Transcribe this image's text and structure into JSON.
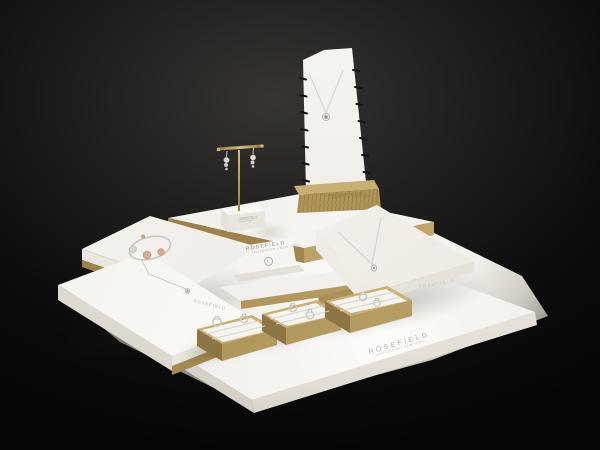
{
  "scene": {
    "description": "Rosefield jewelry counter display set on a dark backdrop",
    "palette": {
      "background": "#0a0a0a",
      "spotlight": "#373431",
      "surface_white": "#f3f1ec",
      "gold": "#a1874f",
      "gold_light": "#c2a96e",
      "wood_gold": "#b2975c",
      "silver": "#cfcdc9",
      "rose_gold": "#d9a890",
      "label_gray": "#aaa49a"
    },
    "brand": {
      "name": "ROSEFIELD",
      "tagline": "AMSTERDAM | NEW YORK"
    },
    "items": {
      "base_platform": {
        "label": "ROSEFIELD",
        "sublabel": "AMSTERDAM | NEW YORK"
      },
      "brand_card": {
        "label": "ROSEFIELD",
        "sublabel": "AMSTERDAM | NEW YORK"
      },
      "earring_stand_cube": {
        "label": "ROSEFIELD",
        "jewelry": "pair of drop earrings"
      },
      "necklace_easel": {
        "label": "ROSEFIELD",
        "sublabel": "AMSTERDAM | NEW YORK",
        "jewelry": "silver pendant necklace"
      },
      "bracelet_wedge": {
        "jewelry": "bangle bracelet with silver and rose-gold beads"
      },
      "necklace_wedge_left": {
        "label": "ROSEFIELD",
        "jewelry": "silver pendant necklace"
      },
      "necklace_wedge_right": {
        "label": "ROSEFIELD",
        "jewelry": "silver pendant necklace"
      },
      "ring_tray_left": {
        "jewelry": "two silver rings"
      },
      "ring_tray_middle": {
        "jewelry": "two silver rings"
      },
      "ring_tray_right": {
        "jewelry": "two silver rings"
      }
    }
  }
}
